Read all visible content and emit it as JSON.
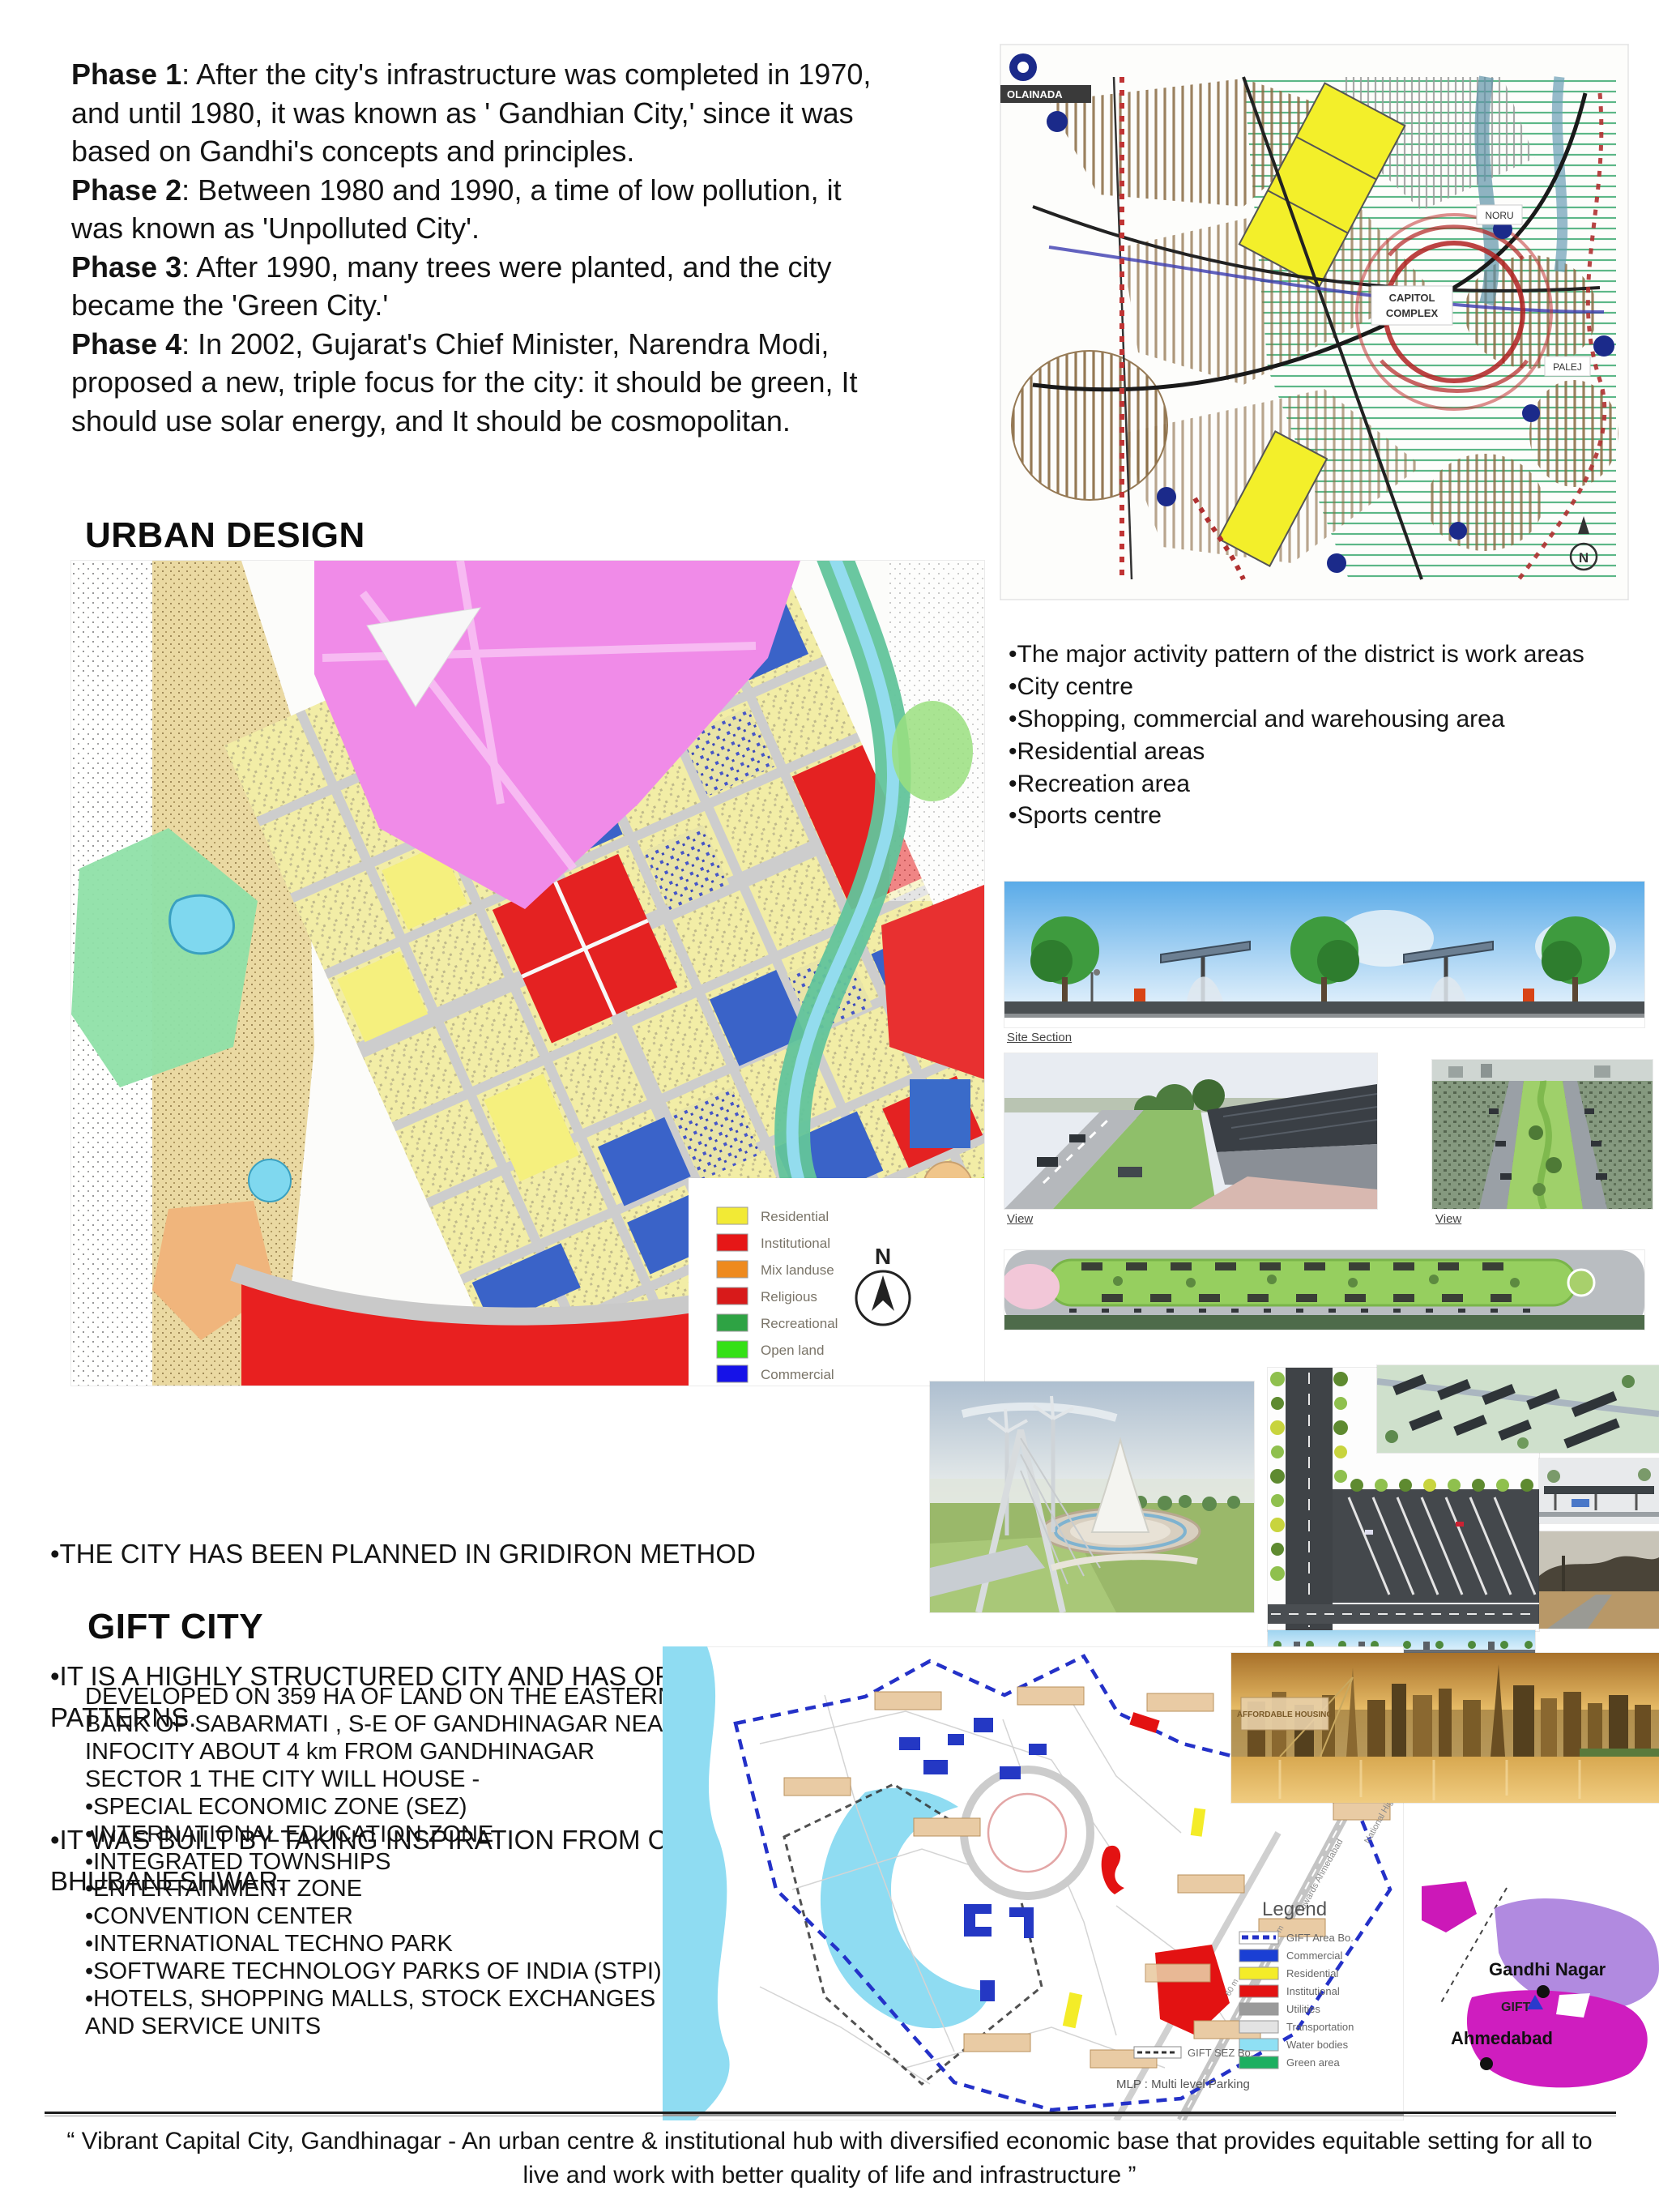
{
  "phases": [
    {
      "label": "Phase 1",
      "text": ": After the city's infrastructure was completed in 1970, and until 1980, it was known as ' Gandhian City,' since it was based on Gandhi's concepts and principles."
    },
    {
      "label": "Phase 2",
      "text": ": Between 1980 and 1990, a time of low pollution, it was known as 'Unpolluted City'."
    },
    {
      "label": "Phase 3",
      "text": ": After 1990, many trees were planted, and the city became the 'Green City.'"
    },
    {
      "label": "Phase 4",
      "text": ": In 2002, Gujarat's Chief Minister, Narendra Modi, proposed a new, triple focus for the city: it should be green, It should use solar energy, and It should be cosmopolitan."
    }
  ],
  "top_map": {
    "label_olainada": "OLAINADA",
    "capitol_line1": "CAPITOL",
    "capitol_line2": "COMPLEX",
    "label_noru": "NORU",
    "label_palej": "PALEJ",
    "compass_label": "N"
  },
  "urban": {
    "heading": "URBAN DESIGN",
    "bullets": [
      "•The major activity pattern of the district is work areas",
      "•City centre",
      "•Shopping, commercial and warehousing area",
      "•Residential areas",
      "•Recreation area",
      "•Sports centre"
    ],
    "legend": [
      {
        "label": "Residential",
        "color": "#f2ea35"
      },
      {
        "label": "Institutional",
        "color": "#e61717"
      },
      {
        "label": "Mix landuse",
        "color": "#ee8a1e"
      },
      {
        "label": "Religious",
        "color": "#d81a1a"
      },
      {
        "label": "Recreational",
        "color": "#2ea344"
      },
      {
        "label": "Open land",
        "color": "#35e016"
      },
      {
        "label": "Commercial",
        "color": "#1612e8"
      }
    ],
    "compass_label": "N",
    "notes": [
      "•THE CITY HAS BEEN PLANNED IN GRIDIRON METHOD",
      "•IT IS A HIGHLY STRUCTURED CITY AND HAS ORDERESSTREET GRID    PATTERNS.",
      "•IT WAS BUILT BY TAKING INSPIRATION FROM CHANDIGARH, BHUBANESHWAR."
    ]
  },
  "renders": {
    "site_section_label": "Site Section",
    "view_label_1": "View",
    "view_label_2": "View"
  },
  "gift": {
    "heading": "GIFT CITY",
    "intro": "DEVELOPED ON 359 HA OF LAND ON THE EASTERN BANK OF SABARMATI , S-E OF GANDHINAGAR NEAR INFOCITY ABOUT 4 km FROM GANDHINAGAR SECTOR 1 THE CITY WILL HOUSE -",
    "bullets": [
      "•SPECIAL ECONOMIC ZONE (SEZ)",
      "•INTERNATIONAL EDUCATION ZONE",
      "•INTEGRATED TOWNSHIPS",
      "•ENTERTAINMENT ZONE",
      "•CONVENTION CENTER",
      "•INTERNATIONAL TECHNO PARK",
      "•SOFTWARE TECHNOLOGY PARKS OF INDIA (STPI)",
      "•HOTELS, SHOPPING MALLS, STOCK EXCHANGES AND SERVICE UNITS"
    ],
    "map": {
      "legend_title": "Legend",
      "legend": [
        {
          "label": "GIFT Area Bo.",
          "color": "#2431c8"
        },
        {
          "label": "Commercial",
          "color": "#1a3fd4"
        },
        {
          "label": "Residential",
          "color": "#f4ec28"
        },
        {
          "label": "Institutional",
          "color": "#e31212"
        },
        {
          "label": "Utilities",
          "color": "#9a9a9a"
        },
        {
          "label": "Transportation",
          "color": "#e3e3e3"
        },
        {
          "label": "Water bodies",
          "color": "#8fe0f4"
        },
        {
          "label": "Green area",
          "color": "#1caf60"
        }
      ],
      "sez_label": "GIFT SEZ Bo.",
      "mlp_label": "MLP : Multi level Parking",
      "road_label_1": "Towards Ahmedabad",
      "road_label_2": "National Highway -8",
      "road_label_3": "60 m",
      "road_label_4": "30 m"
    },
    "skyline_label": "AFFORDABLE HOUSING",
    "locator": {
      "city1": "Gandhi Nagar",
      "city2": "GIFT",
      "city3": "Ahmedabad"
    }
  },
  "footer": {
    "quote": "“ Vibrant Capital City, Gandhinagar - An urban centre & institutional hub with diversified economic base that provides equitable setting for all to live and work with better quality of life and infrastructure ”"
  }
}
